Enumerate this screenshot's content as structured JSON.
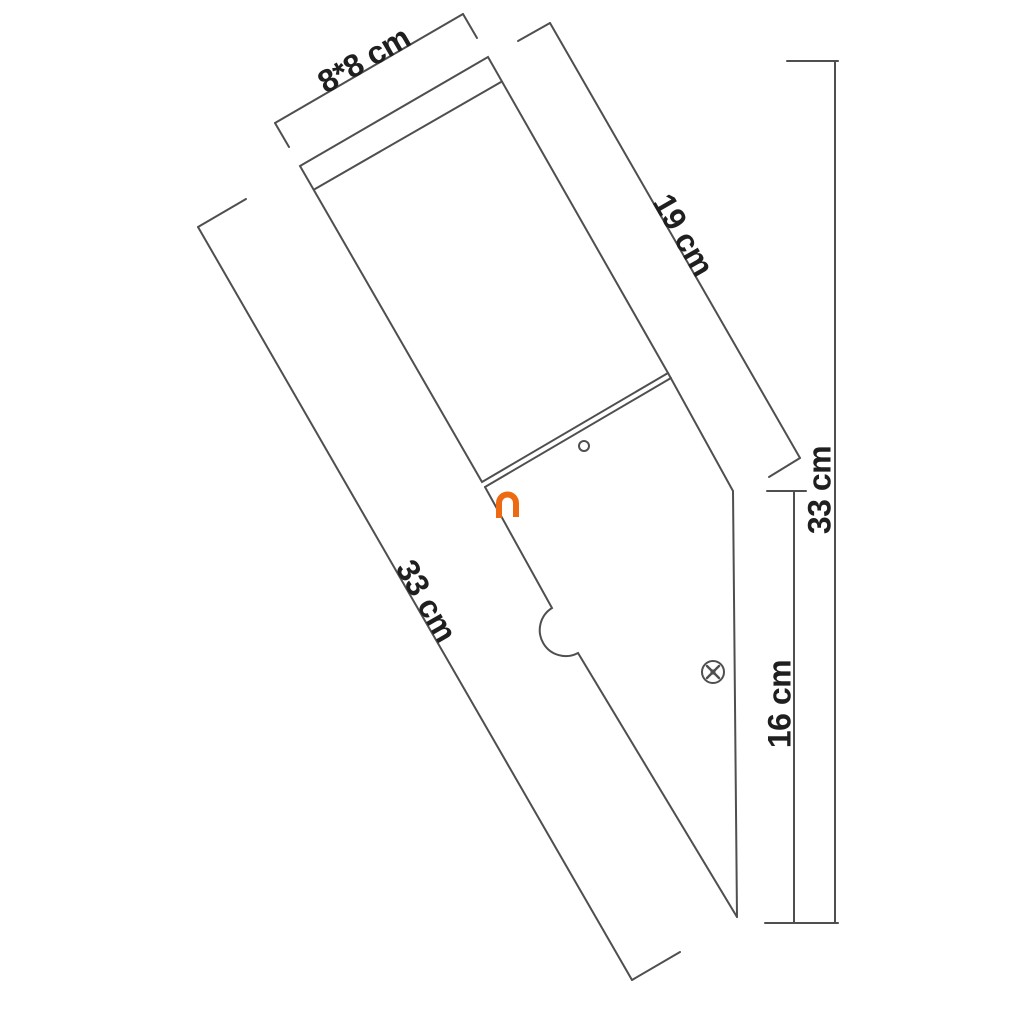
{
  "labels": {
    "top_width": "8*8 cm",
    "head_length": "19 cm",
    "body_length": "33 cm",
    "total_height": "33 cm",
    "lower_section": "16 cm"
  },
  "colors": {
    "line": "#4f4f4f",
    "text": "#1f1f1f",
    "accent_orange": "#ed6a12",
    "background": "#ffffff"
  },
  "icons": {
    "screw": "screw-icon",
    "hole": "mounting-hole-icon",
    "notch": "cable-notch",
    "clip": "orange-clip-mark"
  }
}
